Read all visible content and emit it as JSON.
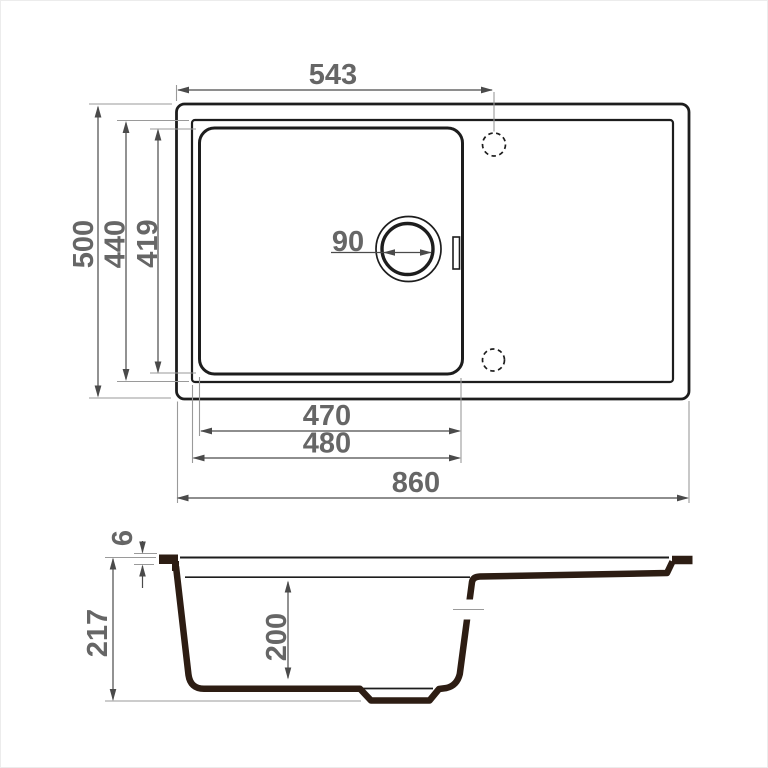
{
  "drawing": {
    "kind": "sink-dimension-drawing",
    "dims": {
      "tap_offset": "543",
      "overall_depth": "500",
      "inner_depth": "440",
      "bowl_depth_plan": "419",
      "drain_diameter": "90",
      "bowl_width": "470",
      "bowl_width_rim": "480",
      "overall_width": "860",
      "rim_thickness": "6",
      "overall_height": "217",
      "bowl_depth": "200"
    },
    "colors": {
      "outline": "#1d1d1d",
      "section": "#2d1d13",
      "dimension": "#4a4a4a",
      "extension": "#9a9a9a",
      "label": "#666666",
      "background": "#ffffff"
    }
  }
}
